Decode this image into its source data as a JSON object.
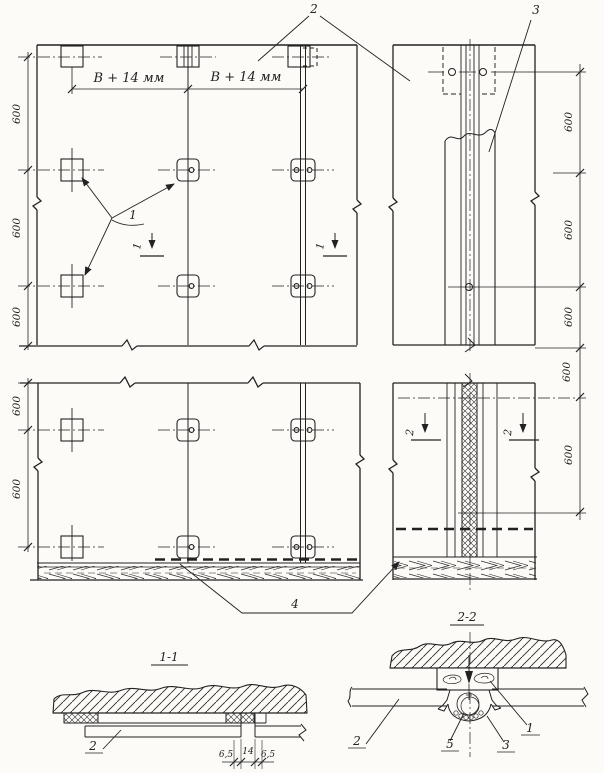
{
  "drawing": {
    "kind": "panel fastening assembly drawing (plan views, edge views, sections)",
    "colors": {
      "ink": "#222222",
      "paper": "#fcfbf8"
    },
    "callouts": {
      "n1": "1",
      "n2": "2",
      "n3": "3",
      "n4": "4",
      "n5": "5"
    },
    "dims": {
      "d600": "600",
      "b14": "В + 14 мм",
      "d6_5": "6,5",
      "d14": "14"
    },
    "sections": {
      "t11": "1-1",
      "t22": "2-2",
      "cut1": "1",
      "cut2": "2"
    }
  }
}
